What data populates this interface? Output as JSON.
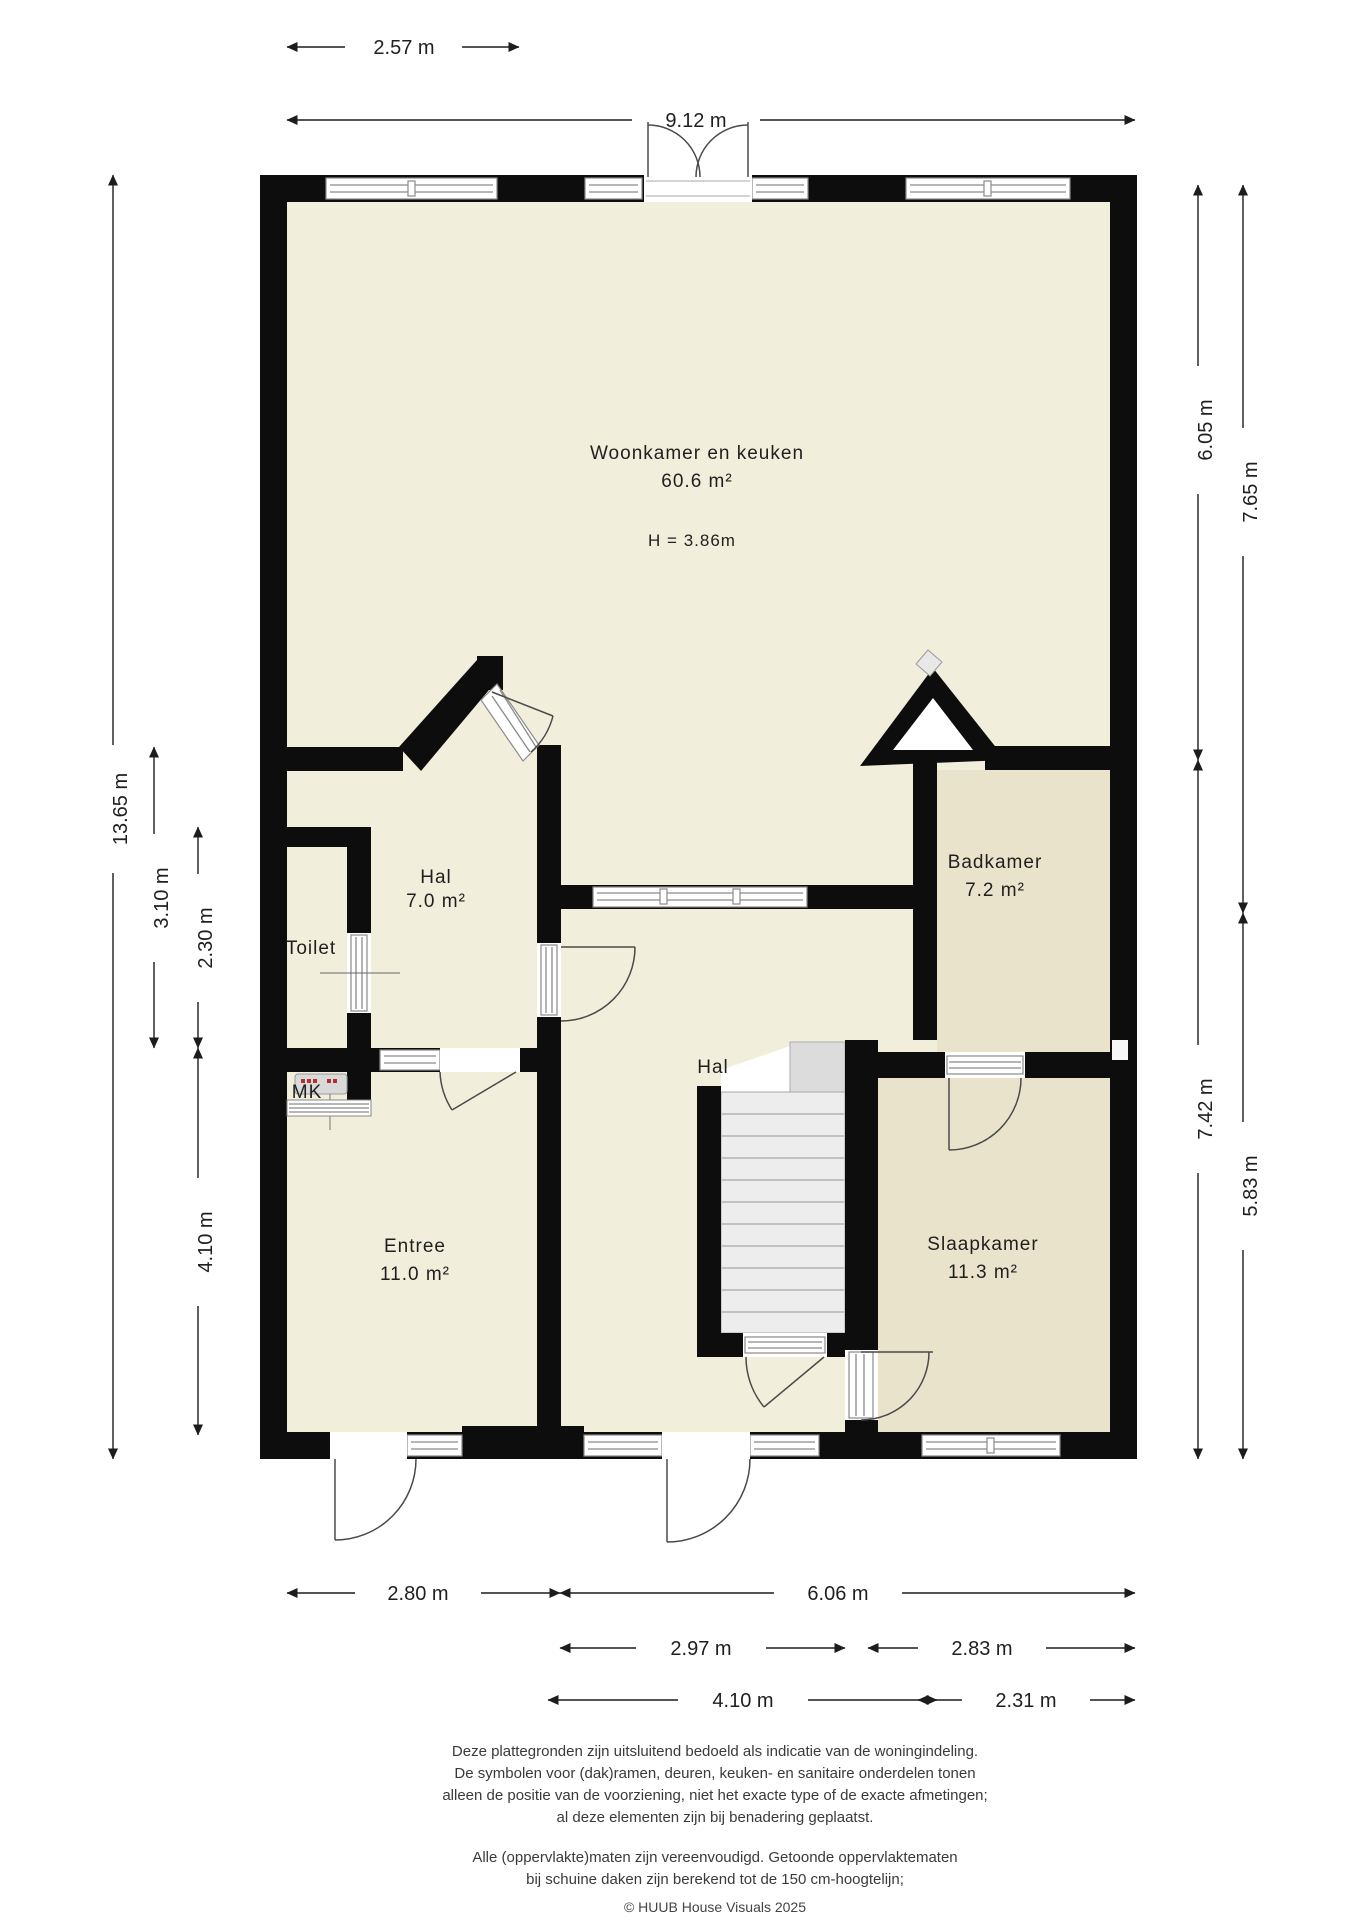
{
  "document": {
    "type": "floor-plan"
  },
  "rooms": {
    "woonkamer": {
      "name": "Woonkamer en keuken",
      "area": "60.6 m²",
      "ceiling_height": "H = 3.86m"
    },
    "hal_boven": {
      "name": "Hal",
      "area": "7.0 m²"
    },
    "toilet": {
      "name": "Toilet"
    },
    "meterkast": {
      "name": "MK"
    },
    "entree": {
      "name": "Entree",
      "area": "11.0 m²"
    },
    "hal_midden": {
      "name": "Hal"
    },
    "badkamer": {
      "name": "Badkamer",
      "area": "7.2 m²"
    },
    "slaapkamer": {
      "name": "Slaapkamer",
      "area": "11.3 m²"
    }
  },
  "dimensions": {
    "top_partial": "2.57 m",
    "top_total": "9.12 m",
    "left_total": "13.65 m",
    "left_hal": "3.10 m",
    "left_toilet": "2.30 m",
    "left_entree": "4.10 m",
    "right_upper_a": "6.05 m",
    "right_upper_b": "7.65 m",
    "right_lower_a": "7.42 m",
    "right_lower_b": "5.83 m",
    "bottom_entree": "2.80 m",
    "bottom_total_right": "6.06 m",
    "bottom_hal": "2.97 m",
    "bottom_slaapkamer": "2.83 m",
    "bottom_hal_outer": "4.10 m",
    "bottom_stairs": "2.31 m"
  },
  "footer": {
    "disclaimer": [
      "Deze plattegronden zijn uitsluitend bedoeld als indicatie van de woningindeling.",
      "De symbolen voor (dak)ramen, deuren, keuken- en sanitaire onderdelen tonen",
      "alleen de positie van de voorziening, niet het exacte type of de exacte afmetingen;",
      "al deze elementen zijn bij benadering geplaatst.",
      "Alle (oppervlakte)maten zijn vereenvoudigd. Getoonde oppervlaktematen",
      "bij schuine daken zijn berekend tot de 150 cm-hoogtelijn;"
    ],
    "copyright": "© HUUB House Visuals 2025"
  },
  "colors": {
    "wall": "#0d0d0d",
    "floor_main": "#f2eedc",
    "floor_alt": "#eae3cc",
    "stairs": "#ededed",
    "background": "#ffffff"
  }
}
